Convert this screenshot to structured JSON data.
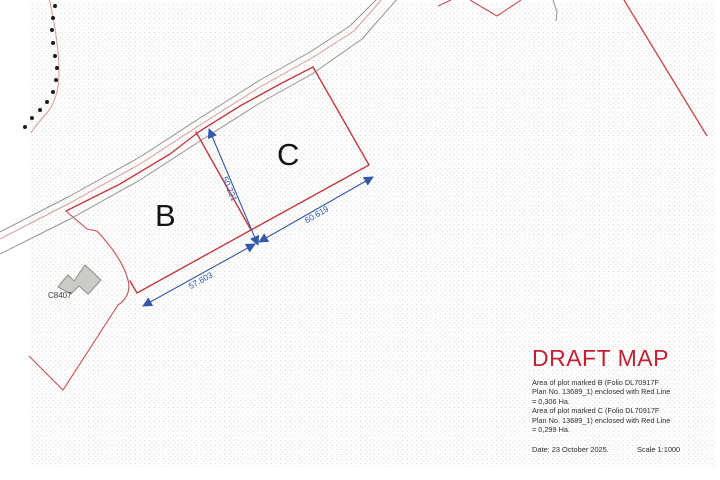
{
  "map": {
    "plot_labels": {
      "b": "B",
      "c": "C"
    },
    "building_label": "C8407",
    "dimensions": {
      "bc_divide": "50.221",
      "b_bottom": "57.603",
      "c_bottom": "60.619"
    }
  },
  "info_panel": {
    "title": "DRAFT MAP",
    "area_lines": [
      "Area of plot marked B (Folio DL70917F",
      "Plan No. 13689_1) enclosed with Red Line",
      "= 0,306 Ha.",
      "Area of plot marked C (Folio DL70917F",
      "Plan No. 13689_1) enclosed with Red Line",
      "= 0,299 Ha."
    ],
    "date": "Date: 23 October 2025.",
    "scale": "Scale 1:1000"
  },
  "colors": {
    "boundary_red": "#c13a43",
    "dimension_blue": "#3558a8",
    "road_gray": "#8f948f",
    "track_pink": "#d9989e",
    "title_red": "#c51f36",
    "building_fill": "#cbcbc8",
    "text_dark": "#2e2e2e"
  }
}
